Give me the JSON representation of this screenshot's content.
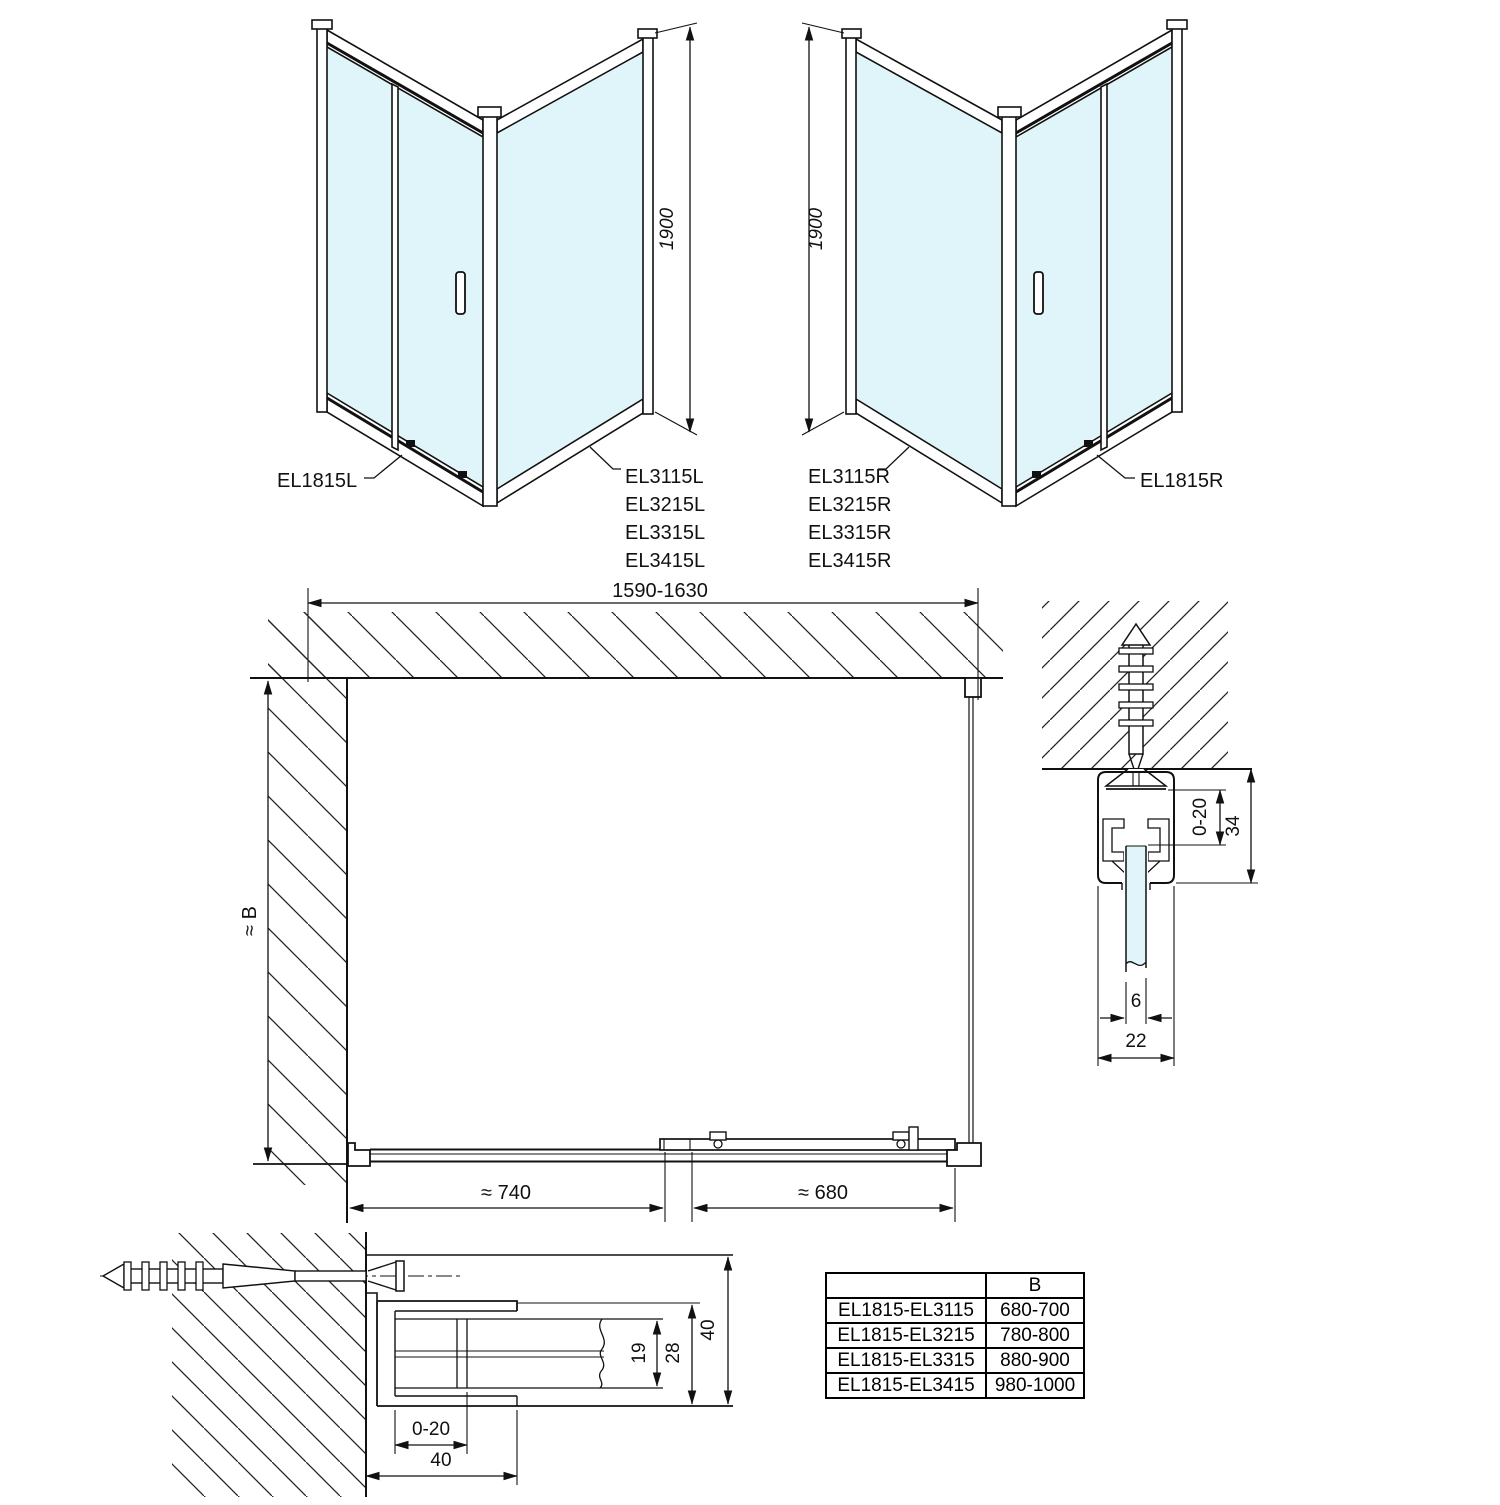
{
  "drawing_left": {
    "door_label": "EL1815L",
    "panel_models": [
      "EL3115L",
      "EL3215L",
      "EL3315L",
      "EL3415L"
    ],
    "height_dim": "1900"
  },
  "drawing_right": {
    "door_label": "EL1815R",
    "panel_models": [
      "EL3115R",
      "EL3215R",
      "EL3315R",
      "EL3415R"
    ],
    "height_dim": "1900"
  },
  "plan_view": {
    "width_dim": "1590-1630",
    "depth_dim": "≈ B",
    "fixed_panel_dim": "≈ 740",
    "door_opening_dim": "≈ 680"
  },
  "wall_profile_detail": {
    "adjustment_dim": "0-20",
    "profile_height_dim": "34",
    "glass_thickness_dim": "6",
    "profile_width_dim": "22"
  },
  "floor_profile_detail": {
    "adjustment_dim": "0-20",
    "mount_width_dim": "40",
    "glass_pocket_dim": "19",
    "channel_depth_dim": "28",
    "profile_width_dim": "40"
  },
  "size_table": {
    "col_header": "B",
    "rows": [
      {
        "models": "EL1815-EL3115",
        "b_range": "680-700"
      },
      {
        "models": "EL1815-EL3215",
        "b_range": "780-800"
      },
      {
        "models": "EL1815-EL3315",
        "b_range": "880-900"
      },
      {
        "models": "EL1815-EL3415",
        "b_range": "980-1000"
      }
    ]
  },
  "colors": {
    "line": "#111111",
    "glass": "#e0f5fa"
  }
}
